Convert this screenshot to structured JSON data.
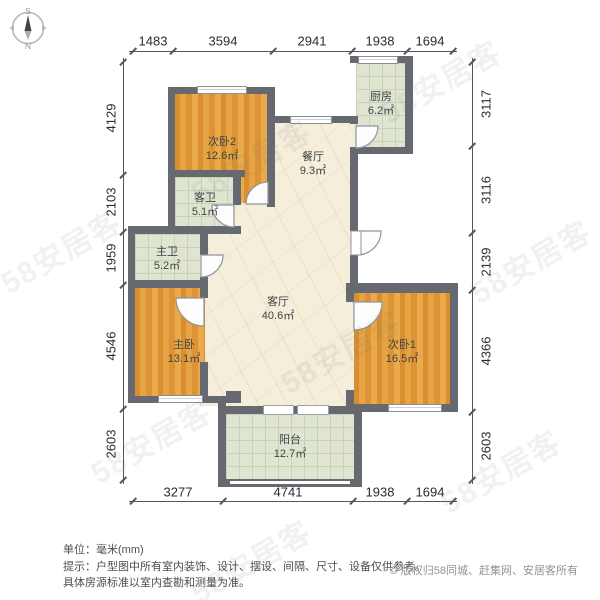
{
  "compass": {
    "south_label": "S",
    "north_label": "N"
  },
  "rooms": [
    {
      "name": "次卧2",
      "area": "12.6㎡"
    },
    {
      "name": "餐厅",
      "area": "9.3㎡"
    },
    {
      "name": "厨房",
      "area": "6.2㎡"
    },
    {
      "name": "客卫",
      "area": "5.1㎡"
    },
    {
      "name": "主卫",
      "area": "5.2㎡"
    },
    {
      "name": "客厅",
      "area": "40.6㎡"
    },
    {
      "name": "主卧",
      "area": "13.1㎡"
    },
    {
      "name": "次卧1",
      "area": "16.5㎡"
    },
    {
      "name": "阳台",
      "area": "12.7㎡"
    }
  ],
  "dimensions": {
    "top": [
      "1483",
      "3594",
      "2941",
      "1938",
      "1694"
    ],
    "bottom": [
      "3277",
      "4741",
      "1938",
      "1694"
    ],
    "left": [
      "4129",
      "2103",
      "1959",
      "4546",
      "2603"
    ],
    "right": [
      "3117",
      "3116",
      "2139",
      "4366",
      "2603"
    ]
  },
  "footer": {
    "unit_note": "单位：毫米(mm)",
    "disclaimer_line1": "提示：户型图中所有室内装饰、设计、摆设、间隔、尺寸、设备仅供参考。",
    "disclaimer_line2": "具体房源标准以室内查勘和测量为准。",
    "copyright": "© 版权归58同城、赶集网、安居客所有"
  },
  "watermark_text": "58安居客",
  "colors": {
    "wall": "#66696f",
    "bedroom_floor": "#e0983a",
    "living_floor": "#f4eedb",
    "tile_floor": "#e0e5d2",
    "dimension_text": "#2b2c2e"
  }
}
